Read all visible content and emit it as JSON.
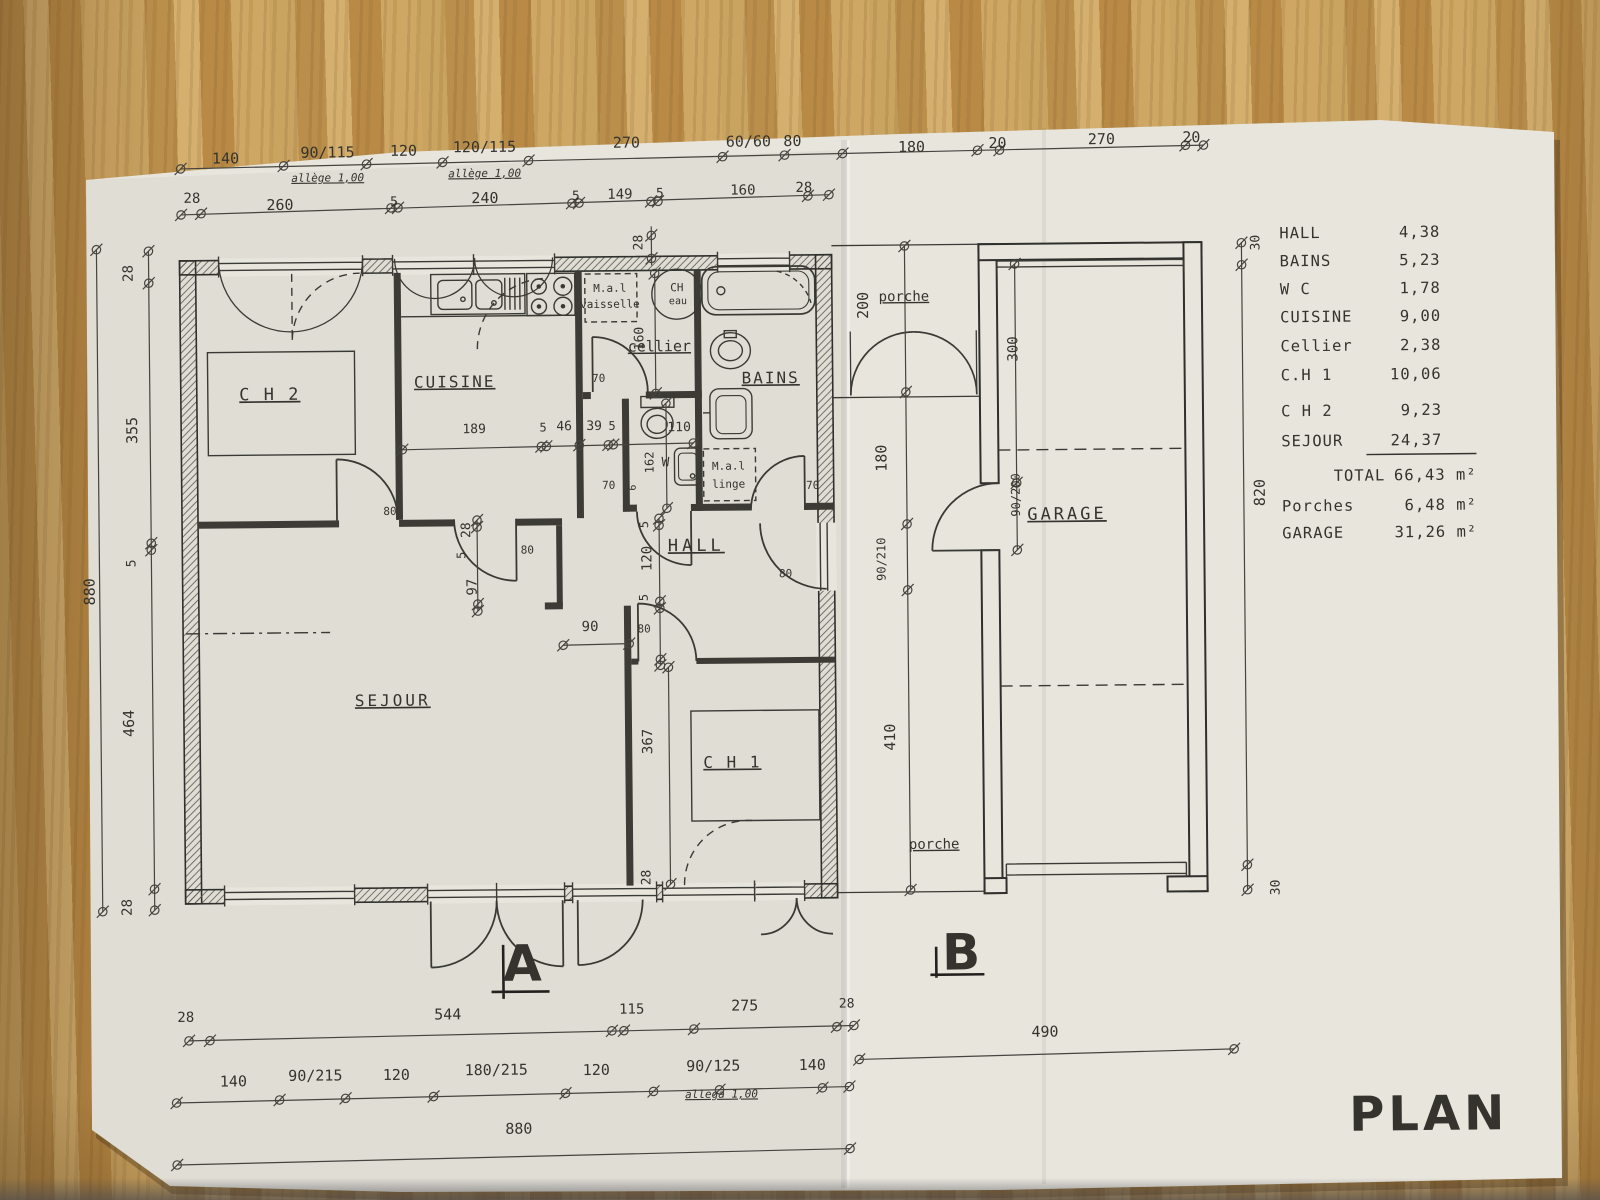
{
  "sheet": {
    "stamp": "PLAN"
  },
  "legend": {
    "rows": [
      {
        "label": "HALL",
        "value": "4,38",
        "y": 243
      },
      {
        "label": "BAINS",
        "value": "5,23",
        "y": 271
      },
      {
        "label": "W C",
        "value": "1,78",
        "y": 299
      },
      {
        "label": "CUISINE",
        "value": "9,00",
        "y": 327
      },
      {
        "label": "Cellier",
        "value": "2,38",
        "y": 356
      },
      {
        "label": "C.H 1",
        "value": "10,06",
        "y": 385
      },
      {
        "label": "C H 2",
        "value": "9,23",
        "y": 421
      },
      {
        "label": "SEJOUR",
        "value": "24,37",
        "y": 451
      },
      {
        "label": "TOTAL",
        "value": "66,43 m²",
        "y": 486,
        "lx": 1335,
        "vx": 1478
      },
      {
        "label": "Porches",
        "value": "6,48 m²",
        "y": 516,
        "vx": 1478
      },
      {
        "label": "GARAGE",
        "value": "31,26 m²",
        "y": 543,
        "vx": 1478
      }
    ]
  },
  "labels": [
    {
      "t": "140",
      "x": 230,
      "y": 158,
      "s": 15,
      "n": "dim-140-top"
    },
    {
      "t": "90/115",
      "x": 332,
      "y": 153,
      "s": 15,
      "n": "dim-window-90-115"
    },
    {
      "t": "120",
      "x": 408,
      "y": 152,
      "s": 15,
      "n": "dim-120-top"
    },
    {
      "t": "120/115",
      "x": 489,
      "y": 149,
      "s": 15,
      "n": "dim-window-120-115"
    },
    {
      "t": "270",
      "x": 631,
      "y": 146,
      "s": 15,
      "n": "dim-270-top"
    },
    {
      "t": "60/60",
      "x": 753,
      "y": 146,
      "s": 15,
      "n": "dim-window-60-60"
    },
    {
      "t": "80",
      "x": 797,
      "y": 146,
      "s": 15,
      "n": "dim-80-top"
    },
    {
      "t": "180",
      "x": 916,
      "y": 153,
      "s": 15,
      "n": "dim-180-porch"
    },
    {
      "t": "20",
      "x": 1002,
      "y": 150,
      "s": 15,
      "n": "dim-20-garage-wall"
    },
    {
      "t": "270",
      "x": 1106,
      "y": 147,
      "s": 15,
      "n": "dim-270-garage"
    },
    {
      "t": "20",
      "x": 1196,
      "y": 146,
      "s": 15,
      "n": "dim-20-garage-wall2"
    },
    {
      "t": "allège 1,00",
      "x": 332,
      "y": 177,
      "s": 11,
      "i": 1,
      "u": 1,
      "n": "note-allege-1"
    },
    {
      "t": "allège 1,00",
      "x": 489,
      "y": 174,
      "s": 11,
      "i": 1,
      "u": 1,
      "n": "note-allege-2"
    },
    {
      "t": "28",
      "x": 196,
      "y": 197,
      "s": 14,
      "n": "dim-28"
    },
    {
      "t": "260",
      "x": 284,
      "y": 205,
      "s": 15,
      "n": "dim-260"
    },
    {
      "t": "5",
      "x": 398,
      "y": 202,
      "s": 13,
      "n": "dim-5"
    },
    {
      "t": "240",
      "x": 489,
      "y": 200,
      "s": 15,
      "n": "dim-240"
    },
    {
      "t": "5",
      "x": 580,
      "y": 198,
      "s": 13,
      "n": "dim-5"
    },
    {
      "t": "149",
      "x": 624,
      "y": 197,
      "s": 14,
      "n": "dim-149"
    },
    {
      "t": "5",
      "x": 664,
      "y": 196,
      "s": 13,
      "n": "dim-5"
    },
    {
      "t": "160",
      "x": 747,
      "y": 194,
      "s": 14,
      "n": "dim-160"
    },
    {
      "t": "28",
      "x": 808,
      "y": 192,
      "s": 14,
      "n": "dim-28"
    },
    {
      "t": "28",
      "x": 646,
      "y": 241,
      "r": -90,
      "s": 13,
      "n": "dim-28-wall"
    },
    {
      "t": "880",
      "x": 95,
      "y": 585,
      "r": -90,
      "s": 15,
      "n": "dim-880-left"
    },
    {
      "t": "28",
      "x": 136,
      "y": 267,
      "r": -90,
      "s": 14,
      "n": "dim-28"
    },
    {
      "t": "355",
      "x": 139,
      "y": 424,
      "r": -90,
      "s": 15,
      "n": "dim-355"
    },
    {
      "t": "5",
      "x": 136,
      "y": 557,
      "r": -90,
      "s": 13,
      "n": "dim-5"
    },
    {
      "t": "464",
      "x": 133,
      "y": 717,
      "r": -90,
      "s": 15,
      "n": "dim-464"
    },
    {
      "t": "28",
      "x": 129,
      "y": 901,
      "r": -90,
      "s": 14,
      "n": "dim-28"
    },
    {
      "t": "200",
      "x": 871,
      "y": 306,
      "r": -90,
      "s": 15,
      "n": "dim-200-porch"
    },
    {
      "t": "180",
      "x": 888,
      "y": 459,
      "r": -90,
      "s": 15,
      "n": "dim-180-right"
    },
    {
      "t": "90/210",
      "x": 886,
      "y": 560,
      "r": -90,
      "s": 12,
      "n": "dim-door-90-210"
    },
    {
      "t": "410",
      "x": 894,
      "y": 738,
      "r": -90,
      "s": 15,
      "n": "dim-410"
    },
    {
      "t": "300",
      "x": 1020,
      "y": 351,
      "r": -90,
      "s": 14,
      "n": "dim-300-garage"
    },
    {
      "t": "90/200",
      "x": 1021,
      "y": 497,
      "r": -90,
      "s": 12,
      "n": "dim-door-90-200"
    },
    {
      "t": "30",
      "x": 1263,
      "y": 247,
      "r": -90,
      "s": 13,
      "n": "dim-30"
    },
    {
      "t": "820",
      "x": 1266,
      "y": 497,
      "r": -90,
      "s": 15,
      "n": "dim-820"
    },
    {
      "t": "30",
      "x": 1277,
      "y": 892,
      "r": -90,
      "s": 13,
      "n": "dim-30"
    },
    {
      "t": "189",
      "x": 476,
      "y": 430,
      "s": 13,
      "n": "dim-189"
    },
    {
      "t": "5",
      "x": 545,
      "y": 429,
      "s": 12,
      "n": "dim-5"
    },
    {
      "t": "46",
      "x": 566,
      "y": 428,
      "s": 13,
      "n": "dim-46"
    },
    {
      "t": "39",
      "x": 596,
      "y": 428,
      "s": 13,
      "n": "dim-39"
    },
    {
      "t": "5",
      "x": 614,
      "y": 428,
      "s": 12,
      "n": "dim-5"
    },
    {
      "t": "110",
      "x": 681,
      "y": 430,
      "s": 13,
      "n": "dim-110"
    },
    {
      "t": "160",
      "x": 646,
      "y": 337,
      "r": -90,
      "s": 13,
      "n": "dim-160-cellier"
    },
    {
      "t": "70",
      "x": 601,
      "y": 380,
      "s": 11,
      "n": "dim-70-cellier-door"
    },
    {
      "t": "162",
      "x": 655,
      "y": 461,
      "r": -90,
      "s": 12,
      "n": "dim-162-wc"
    },
    {
      "t": "70",
      "x": 610,
      "y": 487,
      "s": 11,
      "n": "dim-70-wc-door"
    },
    {
      "t": "6",
      "x": 637,
      "y": 486,
      "r": -90,
      "s": 10,
      "n": "dim-6"
    },
    {
      "t": "70",
      "x": 814,
      "y": 489,
      "s": 11,
      "n": "dim-70-bains-door"
    },
    {
      "t": "28",
      "x": 471,
      "y": 527,
      "r": -90,
      "s": 13,
      "n": "dim-28"
    },
    {
      "t": "5",
      "x": 466,
      "y": 552,
      "r": -90,
      "s": 12,
      "n": "dim-5"
    },
    {
      "t": "97",
      "x": 477,
      "y": 584,
      "r": -90,
      "s": 14,
      "n": "dim-97"
    },
    {
      "t": "5",
      "x": 649,
      "y": 523,
      "r": -90,
      "s": 12,
      "n": "dim-5"
    },
    {
      "t": "120",
      "x": 652,
      "y": 557,
      "r": -90,
      "s": 14,
      "n": "dim-120-hall"
    },
    {
      "t": "5",
      "x": 648,
      "y": 596,
      "r": -90,
      "s": 12,
      "n": "dim-5"
    },
    {
      "t": "90",
      "x": 590,
      "y": 629,
      "s": 14,
      "n": "dim-90-opening"
    },
    {
      "t": "80",
      "x": 391,
      "y": 511,
      "s": 11,
      "n": "dim-80-door"
    },
    {
      "t": "80",
      "x": 528,
      "y": 551,
      "s": 11,
      "n": "dim-80-door"
    },
    {
      "t": "80",
      "x": 644,
      "y": 631,
      "s": 11,
      "n": "dim-80-door"
    },
    {
      "t": "80",
      "x": 786,
      "y": 577,
      "s": 11,
      "n": "dim-80-door"
    },
    {
      "t": "367",
      "x": 651,
      "y": 740,
      "r": -90,
      "s": 14,
      "n": "dim-367"
    },
    {
      "t": "28",
      "x": 648,
      "y": 876,
      "r": -90,
      "s": 13,
      "n": "dim-28"
    },
    {
      "t": "28",
      "x": 182,
      "y": 1016,
      "s": 14,
      "n": "dim-28"
    },
    {
      "t": "544",
      "x": 444,
      "y": 1016,
      "s": 15,
      "n": "dim-544"
    },
    {
      "t": "115",
      "x": 628,
      "y": 1012,
      "s": 14,
      "n": "dim-115"
    },
    {
      "t": "275",
      "x": 741,
      "y": 1010,
      "s": 15,
      "n": "dim-275"
    },
    {
      "t": "28",
      "x": 843,
      "y": 1008,
      "s": 13,
      "n": "dim-28"
    },
    {
      "t": "140",
      "x": 229,
      "y": 1081,
      "s": 15,
      "n": "dim-140"
    },
    {
      "t": "90/215",
      "x": 311,
      "y": 1076,
      "s": 15,
      "n": "dim-window-90-215"
    },
    {
      "t": "120",
      "x": 392,
      "y": 1076,
      "s": 15,
      "n": "dim-120"
    },
    {
      "t": "180/215",
      "x": 492,
      "y": 1072,
      "s": 15,
      "n": "dim-door-180-215"
    },
    {
      "t": "120",
      "x": 592,
      "y": 1073,
      "s": 15,
      "n": "dim-120"
    },
    {
      "t": "90/125",
      "x": 709,
      "y": 1070,
      "s": 15,
      "n": "dim-window-90-125"
    },
    {
      "t": "allega 1,00",
      "x": 717,
      "y": 1097,
      "s": 11,
      "i": 1,
      "u": 1,
      "n": "note-allege-3"
    },
    {
      "t": "140",
      "x": 808,
      "y": 1070,
      "s": 15,
      "n": "dim-140"
    },
    {
      "t": "880",
      "x": 514,
      "y": 1131,
      "s": 15,
      "n": "dim-880-bottom"
    },
    {
      "t": "490",
      "x": 1041,
      "y": 1039,
      "s": 15,
      "n": "dim-490"
    },
    {
      "t": "C H 2",
      "x": 272,
      "y": 395,
      "s": 17,
      "u": 1,
      "sp": 2,
      "n": "room-label-ch2"
    },
    {
      "t": "CUISINE",
      "x": 457,
      "y": 384,
      "s": 16,
      "u": 1,
      "sp": 2,
      "n": "room-label-cuisine"
    },
    {
      "t": "cellier",
      "x": 662,
      "y": 350,
      "s": 15,
      "u": 1,
      "n": "room-label-cellier"
    },
    {
      "t": "BAINS",
      "x": 773,
      "y": 383,
      "s": 16,
      "u": 1,
      "sp": 2,
      "n": "room-label-bains"
    },
    {
      "t": "HALL",
      "x": 697,
      "y": 550,
      "s": 17,
      "u": 1,
      "sp": 4,
      "n": "room-label-hall"
    },
    {
      "t": "SEJOUR",
      "x": 392,
      "y": 702,
      "s": 16,
      "u": 1,
      "sp": 3,
      "n": "room-label-sejour"
    },
    {
      "t": "C H 1",
      "x": 731,
      "y": 767,
      "s": 16,
      "u": 1,
      "sp": 2,
      "n": "room-label-ch1"
    },
    {
      "t": "GARAGE",
      "x": 1068,
      "y": 522,
      "s": 17,
      "u": 1,
      "sp": 3,
      "n": "room-label-garage"
    },
    {
      "t": "porche",
      "x": 907,
      "y": 302,
      "s": 14,
      "u": 1,
      "n": "room-label-porche-top"
    },
    {
      "t": "porche",
      "x": 932,
      "y": 850,
      "s": 14,
      "u": 1,
      "n": "room-label-porche-bottom"
    },
    {
      "t": "W",
      "x": 667,
      "y": 465,
      "s": 13,
      "n": "room-label-wc"
    },
    {
      "t": "M.a.l",
      "x": 613,
      "y": 290,
      "s": 11,
      "n": "appliance-label-dishwasher-1"
    },
    {
      "t": "vaisselle",
      "x": 613,
      "y": 306,
      "s": 11,
      "n": "appliance-label-dishwasher-2"
    },
    {
      "t": "M.a.l",
      "x": 730,
      "y": 469,
      "s": 11,
      "n": "appliance-label-washer-1"
    },
    {
      "t": "linge",
      "x": 730,
      "y": 487,
      "s": 11,
      "n": "appliance-label-washer-2"
    },
    {
      "t": "CH",
      "x": 680,
      "y": 290,
      "s": 11,
      "n": "appliance-label-waterheater-1"
    },
    {
      "t": "eau",
      "x": 681,
      "y": 303,
      "s": 10,
      "n": "appliance-label-waterheater-2"
    },
    {
      "t": "A",
      "x": 519,
      "y": 978,
      "s": 50,
      "w": 800,
      "n": "section-mark-a"
    },
    {
      "t": "B",
      "x": 958,
      "y": 971,
      "s": 50,
      "w": 800,
      "n": "section-mark-b"
    },
    {
      "t": "PLAN",
      "x": 1424,
      "y": 1136,
      "s": 48,
      "w": 800,
      "sp": 4,
      "n": "plan-stamp"
    }
  ]
}
